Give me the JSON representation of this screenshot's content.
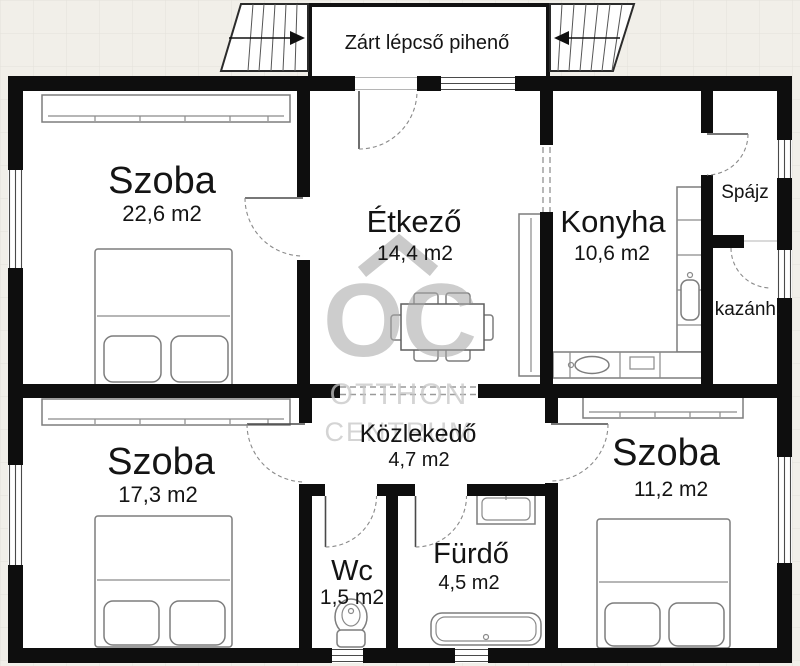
{
  "floor_plan": {
    "landing": {
      "label": "Zárt lépcső pihenő"
    },
    "rooms": {
      "bedroom_top_left": {
        "name": "Szoba",
        "area": "22,6 m2"
      },
      "dining": {
        "name": "Étkező",
        "area": "14,4 m2"
      },
      "kitchen": {
        "name": "Konyha",
        "area": "10,6 m2"
      },
      "pantry": {
        "name": "Spájz"
      },
      "boiler": {
        "name": "kazánh."
      },
      "bedroom_bottom_left": {
        "name": "Szoba",
        "area": "17,3 m2"
      },
      "hallway": {
        "name": "Közlekedő",
        "area": "4,7 m2"
      },
      "bedroom_bottom_right": {
        "name": "Szoba",
        "area": "11,2 m2"
      },
      "wc": {
        "name": "Wc",
        "area": "1,5 m2"
      },
      "bathroom": {
        "name": "Fürdő",
        "area": "4,5 m2"
      }
    },
    "watermark": {
      "initials": "OC",
      "line1": "OTTHON",
      "line2": "CENTRUM"
    },
    "colors": {
      "wall": "#0e0e0e",
      "room_fill": "#ffffff",
      "background": "#f1efe9",
      "furniture_line": "#7d7d7d",
      "watermark_gray": "#a6a6a6"
    }
  }
}
